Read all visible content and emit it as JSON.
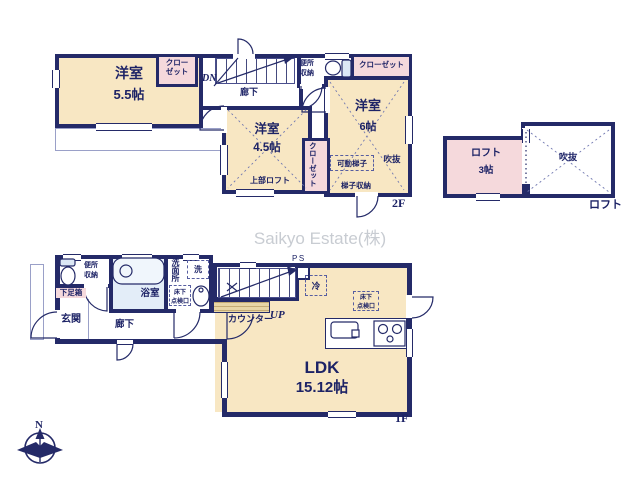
{
  "colors": {
    "wall": "#242a68",
    "text": "#1d2366",
    "room_fill": "#f8e7c3",
    "closet_fill": "#f5d9dc",
    "bath_fill": "#e3edf8",
    "counter_fill": "#e8d6a6",
    "watermark": "#c8ccd2"
  },
  "watermark_text": "Saikyo Estate(株)",
  "compass": {
    "north": "N"
  },
  "floor2": {
    "title": "2F",
    "west_room": {
      "name": "洋室",
      "size": "5.5帖"
    },
    "west_closet": {
      "line1": "クロー",
      "line2": "ゼット"
    },
    "stairs_direction": "DN",
    "hallway": "廊下",
    "toilet": {
      "line1": "便所",
      "line2": "収納"
    },
    "east_closet": "クローゼット",
    "east_room": {
      "name": "洋室",
      "size": "6帖"
    },
    "void": "吹抜",
    "movable_ladder": "可動梯子",
    "ladder_storage": "梯子収納",
    "south_room": {
      "name": "洋室",
      "size": "4.5帖",
      "upper_loft": "上部ロフト"
    },
    "south_closet": "クローゼット"
  },
  "loft": {
    "title": "ロフト",
    "room": {
      "name": "ロフト",
      "size": "3帖"
    },
    "void": "吹抜"
  },
  "floor1": {
    "title": "1F",
    "toilet": {
      "line1": "便所",
      "line2": "収納"
    },
    "shoe_cabinet": "下足箱",
    "entrance": "玄関",
    "hallway": "廊下",
    "bathroom": "浴室",
    "washroom": "洗面所",
    "washer": "洗",
    "floor_hatch": {
      "line1": "床下",
      "line2": "点検口"
    },
    "counter": "カウンター",
    "stairs_direction": "UP",
    "pipe_space": "PS",
    "refrigerator": "冷",
    "ldk": {
      "name": "LDK",
      "size": "15.12帖"
    },
    "ldk_floor_hatch": {
      "line1": "床下",
      "line2": "点検口"
    }
  }
}
